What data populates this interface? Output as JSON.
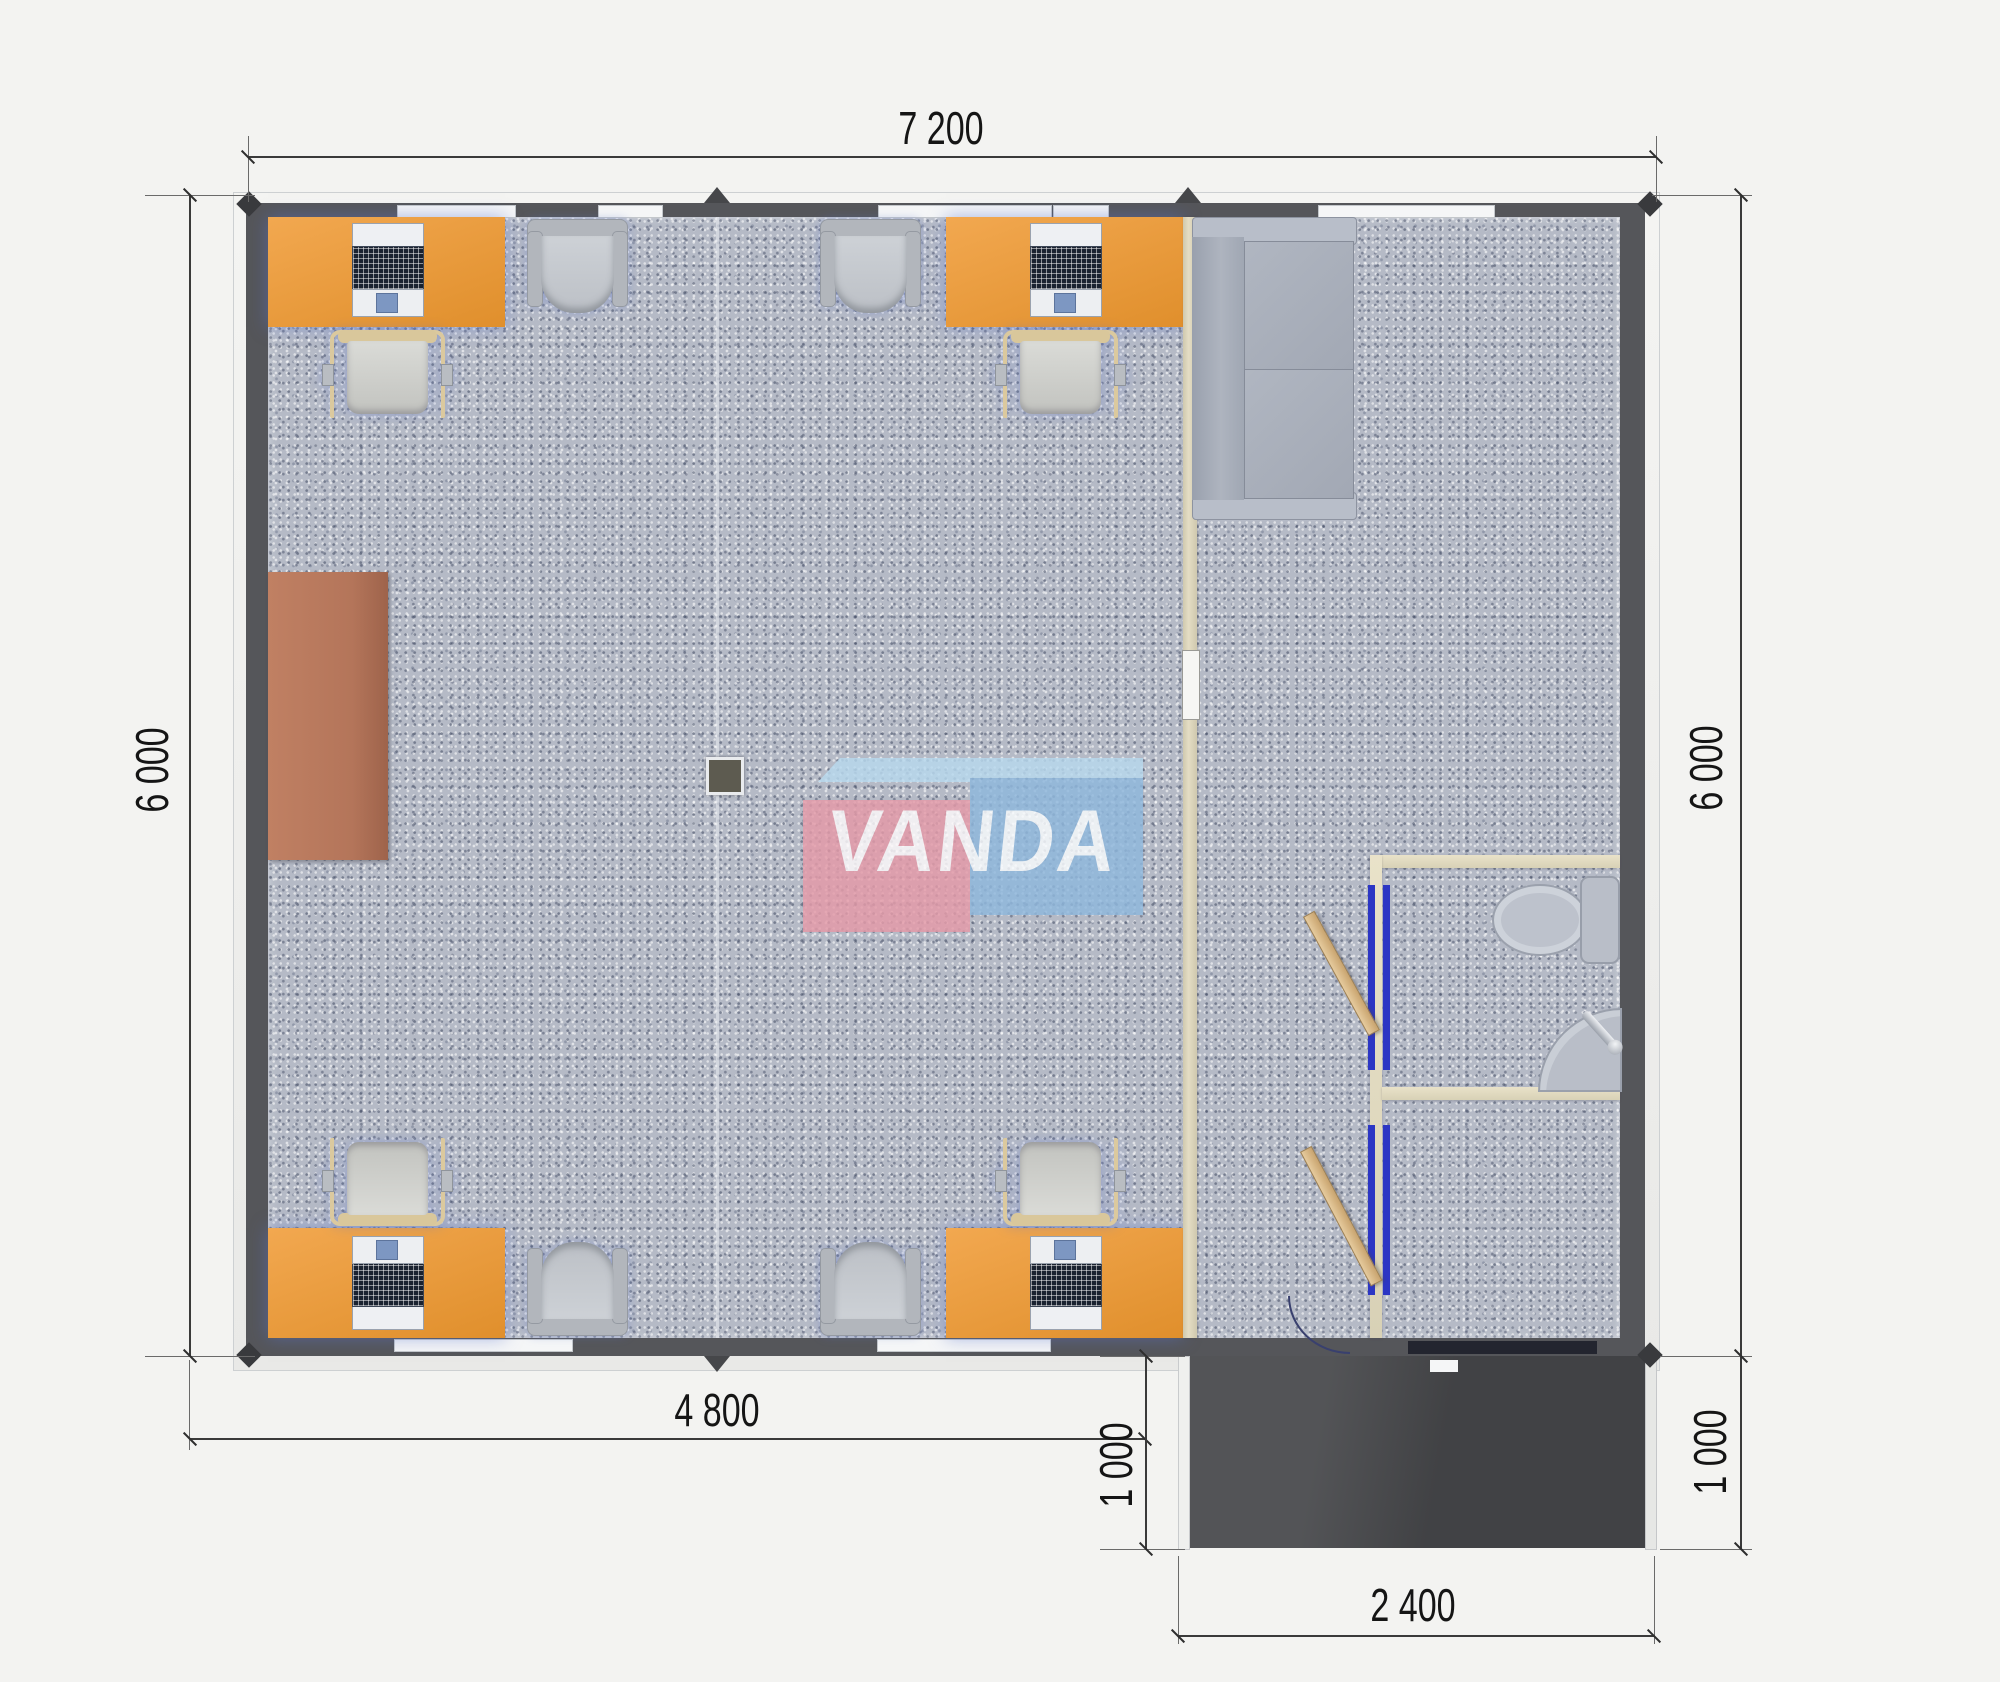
{
  "drawing": {
    "type": "modular-office floor plan, top view",
    "logo": {
      "text": "VANDA",
      "pink_box": "#e59aa8",
      "blue_box": "#8fb8dd",
      "top_band": "#b8d9ee"
    },
    "dimensions": {
      "top_width": {
        "label": "7 200"
      },
      "left_height": {
        "label": "6 000"
      },
      "right_height": {
        "label": "6 000"
      },
      "bottom_width": {
        "label": "4 800"
      },
      "porch_depth_left": {
        "label": "1 000"
      },
      "porch_depth_right": {
        "label": "1 000"
      },
      "porch_width": {
        "label": "2 400"
      }
    },
    "colors": {
      "background": "#f3f3f1",
      "wall_dark": "#55565a",
      "carpet_gray": "#b5bac6",
      "desk_orange": "#e9993c",
      "cabinet_brown": "#b8795c",
      "partition_beige": "#ded7c0",
      "door_wood": "#d9b88a",
      "door_frame_blue": "#2c36c4",
      "porch_dark": "#4a4b4e",
      "dimension_text": "#151515"
    },
    "furniture_icons": [
      "office-desk",
      "desktop-computer",
      "task-chair",
      "armchair",
      "storage-cabinet",
      "sofa",
      "toilet",
      "corner-sink",
      "open-door",
      "floor-outlet-box"
    ]
  }
}
